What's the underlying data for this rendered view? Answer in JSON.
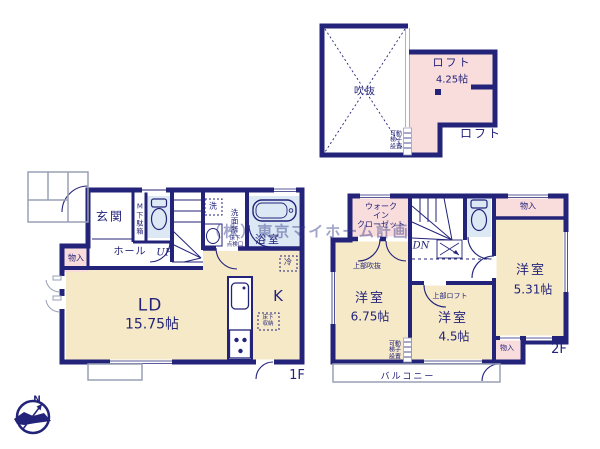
{
  "watermark": "（株）東京マイホーム計画",
  "colors": {
    "wall": "#23237a",
    "room_cream": "#f6e9c8",
    "room_pink": "#f9dcdc",
    "room_blue": "#dce8f4",
    "outline_gray": "#98a0b4"
  },
  "compass": {
    "north": "N"
  },
  "loft": {
    "void_label": "吹抜",
    "name": "ロフト",
    "size": "4.25帖",
    "ladder_note": [
      "可動",
      "梯子",
      "設置"
    ],
    "floor_label": "ロフト"
  },
  "f1": {
    "entrance": "玄関",
    "shoe_box": "M下駄箱",
    "hall": "ホール",
    "storage": "物入",
    "stairs": "UP",
    "washer": "洗",
    "washroom": "洗面所",
    "floor_hatch": [
      "床下",
      "点検口"
    ],
    "bath": "浴室",
    "living": "LD",
    "living_size": "15.75帖",
    "kitchen": "K",
    "floor_storage": [
      "床下",
      "収納"
    ],
    "fridge": "冷",
    "floor_label": "1F"
  },
  "f2": {
    "wic": [
      "ウォーク",
      "イン",
      "クローゼット"
    ],
    "stairs": "DN",
    "storage_top": "物入",
    "room_right": {
      "name": "洋室",
      "size": "5.31帖"
    },
    "room_left": {
      "name": "洋室",
      "size": "6.75帖",
      "note": "上部吹抜"
    },
    "room_mid": {
      "name": "洋室",
      "size": "4.5帖",
      "note": "上部ロフト"
    },
    "ladder_note": [
      "可動",
      "梯子",
      "設置"
    ],
    "storage_bottom": "物入",
    "balcony": "バルコニー",
    "floor_label": "2F"
  }
}
